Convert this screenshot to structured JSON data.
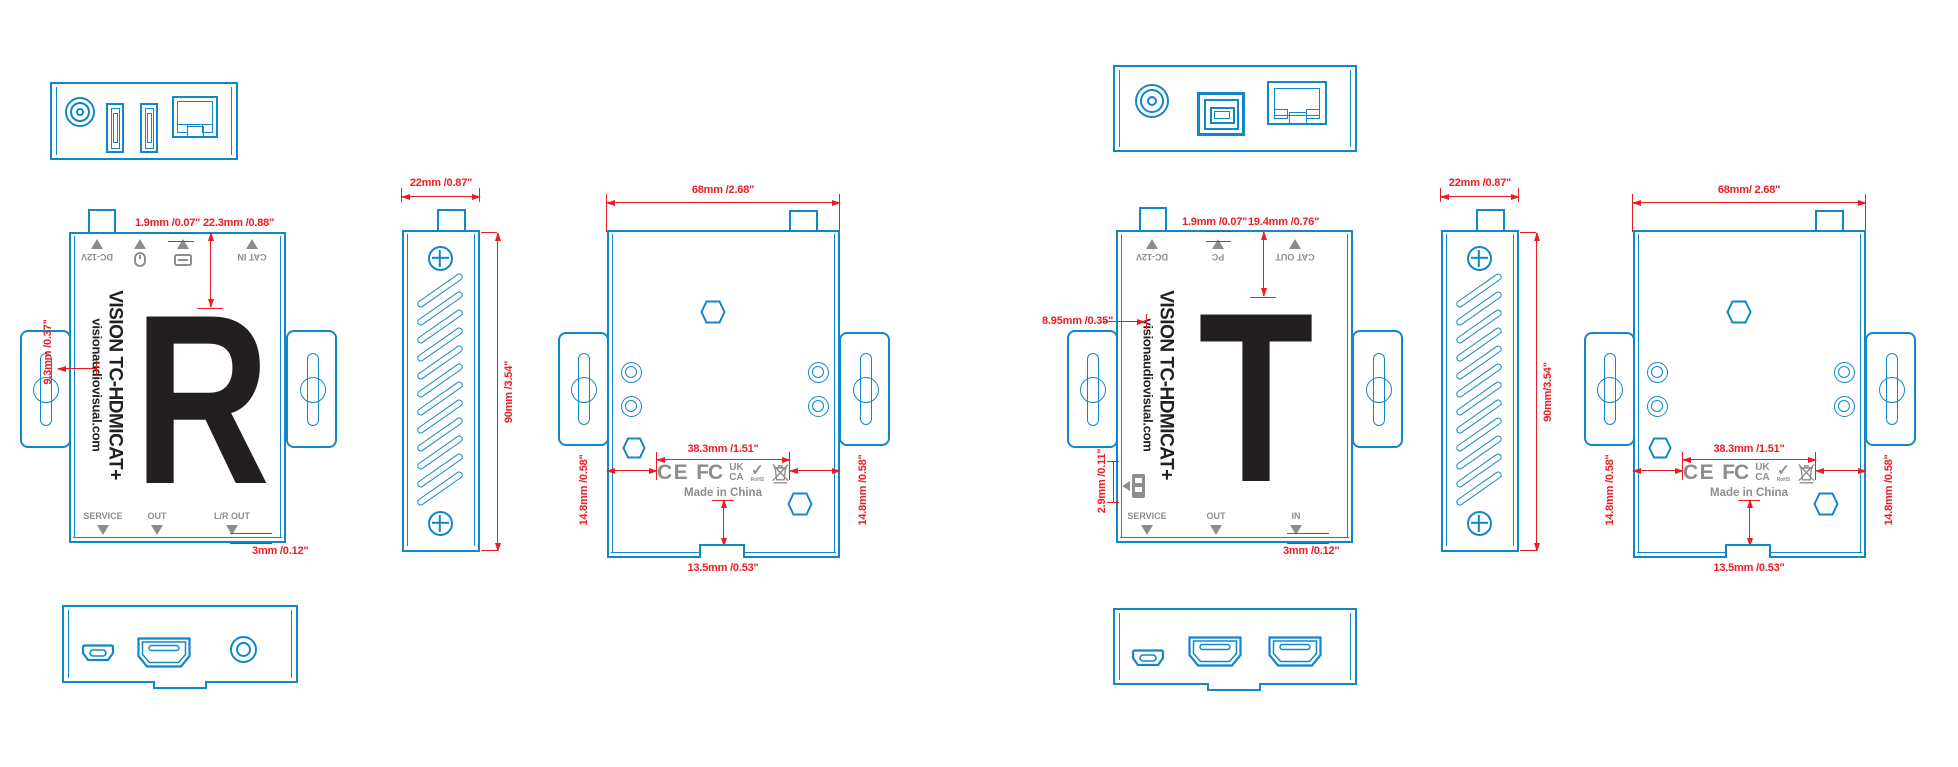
{
  "colors": {
    "outline_blue": "#1287c8",
    "dimension_red": "#ec1c24",
    "label_gray": "#8d8d8d",
    "ink_black": "#231f20"
  },
  "brand": {
    "line1": "VISION TC-HDMICAT+",
    "line2": "visionaudiovisual.com"
  },
  "certs": {
    "ce": "CE",
    "fcc": "FC",
    "ukca_top": "UK",
    "ukca_bottom": "CA",
    "check": "✓",
    "rohs": "RoHS",
    "origin": "Made in China"
  },
  "receiver": {
    "letter": "R",
    "rear_labels": {
      "power": "DC-12V",
      "cat": "CAT IN"
    },
    "front_labels": {
      "service": "SERVICE",
      "out": "OUT",
      "lr": "L/R OUT"
    },
    "dims": {
      "gap": "1.9mm /0.07\"",
      "top_offset": "22.3mm /0.88\"",
      "left_offset": "9.3mm /0.37\"",
      "bottom_gap": "3mm /0.12\"",
      "depth": "22mm /0.87\"",
      "height": "90mm /3.54\"",
      "width": "68mm /2.68\"",
      "label_span": "38.3mm /1.51\"",
      "side_left": "14.8mm /0.58\"",
      "side_right": "14.8mm /0.58\"",
      "notch": "13.5mm /0.53\""
    }
  },
  "transmitter": {
    "letter": "T",
    "rear_labels": {
      "power": "DC-12V",
      "pc": "PC",
      "cat": "CAT OUT"
    },
    "front_labels": {
      "service": "SERVICE",
      "out": "OUT",
      "in": "IN"
    },
    "dims": {
      "gap": "1.9mm /0.07\"",
      "top_offset": "19.4mm /0.76\"",
      "brand_offset": "8.95mm /0.35\"",
      "switch_offset": "2.9mm /0.11\"",
      "bottom_gap": "3mm /0.12\"",
      "depth": "22mm /0.87\"",
      "height": "90mm/3.54\"",
      "width": "68mm/ 2.68\"",
      "label_span": "38.3mm /1.51\"",
      "side_left": "14.8mm /0.58\"",
      "side_right": "14.8mm /0.58\"",
      "notch": "13.5mm /0.53\""
    }
  }
}
